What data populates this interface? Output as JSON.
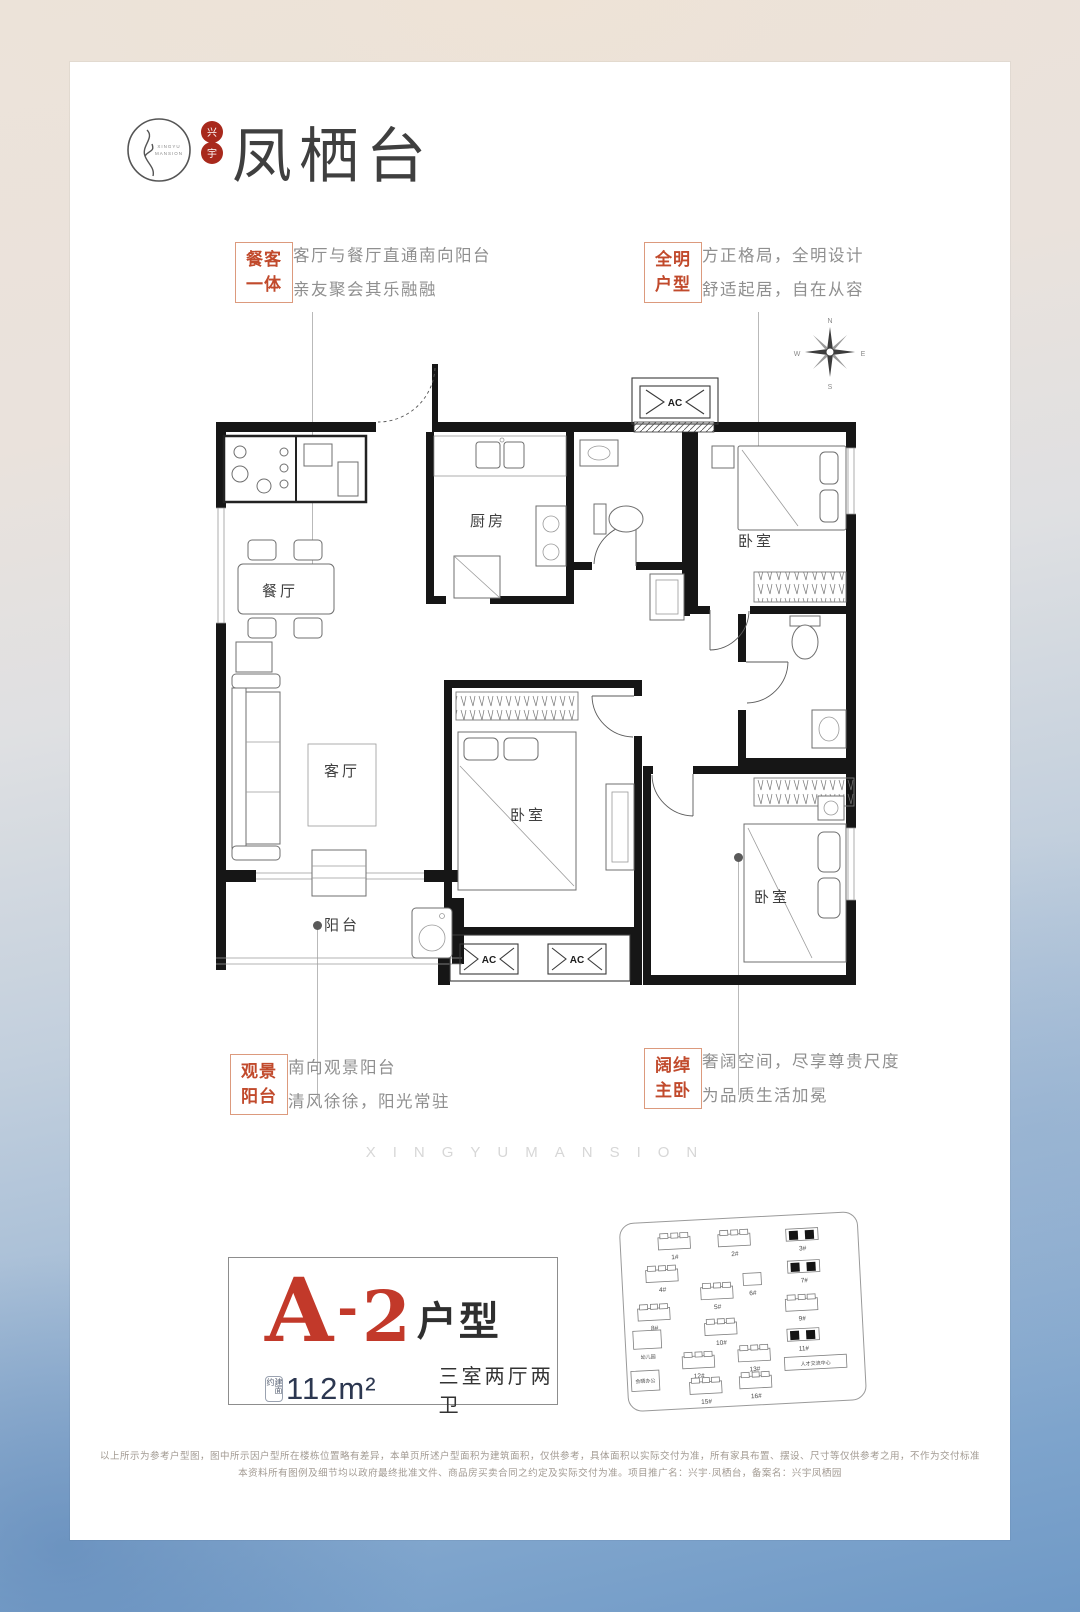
{
  "brand": {
    "logo_text_1": "XINGYU",
    "logo_text_2": "MANSION",
    "seal_char_1": "兴",
    "seal_char_2": "宇",
    "title": "凤栖台"
  },
  "callouts": {
    "dining": {
      "tag1": "餐客",
      "tag2": "一体",
      "line1": "客厅与餐厅直通南向阳台",
      "line2": "亲友聚会其乐融融"
    },
    "bright": {
      "tag1": "全明",
      "tag2": "户型",
      "line1": "方正格局，全明设计",
      "line2": "舒适起居，自在从容"
    },
    "balcony": {
      "tag1": "观景",
      "tag2": "阳台",
      "line1": "南向观景阳台",
      "line2": "清风徐徐，阳光常驻"
    },
    "master": {
      "tag1": "阔绰",
      "tag2": "主卧",
      "line1": "奢阔空间，尽享尊贵尺度",
      "line2": "为品质生活加冕"
    }
  },
  "floorplan": {
    "room_dining": "餐厅",
    "room_kitchen": "厨房",
    "room_living": "客厅",
    "room_balcony": "阳台",
    "room_bedroom_north": "卧室",
    "room_bedroom_mid": "卧室",
    "room_bedroom_master": "卧室",
    "ac": "AC",
    "compass_n": "N",
    "compass_e": "E",
    "compass_s": "S",
    "compass_w": "W"
  },
  "watermark": "XINGYUMANSION",
  "unit": {
    "letter": "A",
    "dash": "-",
    "number": "2",
    "suffix": "户型",
    "area_label": "建面约",
    "area": "112m²",
    "layout": "三室两厅两卫"
  },
  "siteplan": {
    "b1": "1#",
    "b2": "2#",
    "b3": "3#",
    "b4": "4#",
    "b5": "5#",
    "b6": "6#",
    "b7": "7#",
    "b8": "8#",
    "b9": "9#",
    "b10": "10#",
    "b11": "11#",
    "b12": "12#",
    "b13": "13#",
    "b15": "15#",
    "b16": "16#",
    "kindergarten": "幼儿园",
    "talent_center": "人才交流中心",
    "office": "会晤办公"
  },
  "disclaimer": {
    "line1": "以上所示为参考户型图，图中所示因户型所在楼栋位置略有差异，本单页所述户型面积为建筑面积，仅供参考，具体面积以实际交付为准，所有家具布置、摆设、尺寸等仅供参考之用，不作为交付标准",
    "line2": "本资料所有图例及细节均以政府最终批准文件、商品房买卖合同之约定及实际交付为准。项目推广名：兴宇·凤栖台，备案名：兴宇凤栖园"
  }
}
